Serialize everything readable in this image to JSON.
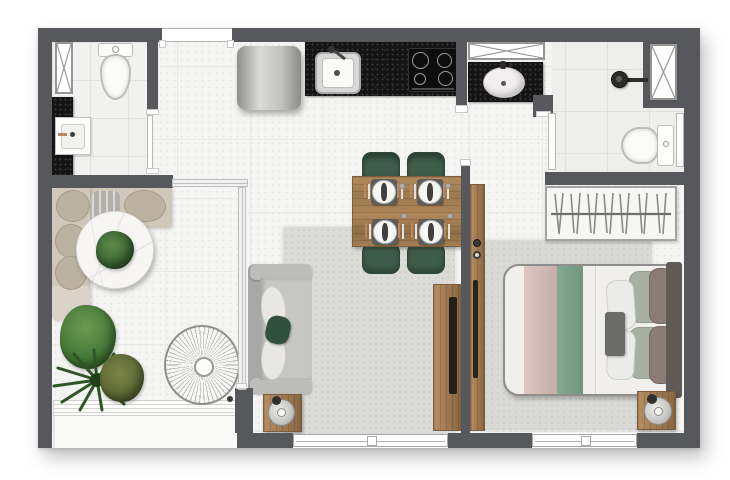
{
  "title": "Studio apartment floor plan (top-down architectural rendering, no visible text)",
  "canvas": {
    "width_px": 730,
    "height_px": 480
  },
  "palette": {
    "wall_gray": "#57585b",
    "floor_white": "#f4f4f2",
    "granite_black": "#141414",
    "wood_brown": "#a67e53",
    "chair_green": "#3f5d4b",
    "pillow_green": "#30503e",
    "bed_stripe_green": "#7ea28c",
    "bed_stripe_pink": "#d2bcb7",
    "rug_gray": "#dbdbd8",
    "sofa_gray": "#c6c6c4",
    "bench_beige": "#cfc8ba",
    "plant_green": "#3a6332",
    "glass_frame": "#bfc1c1"
  },
  "labels": {
    "balcony_bench": "L-shaped balcony bench with cushions",
    "round_table": "Round marble side table with plant centerpiece",
    "potted_plants": "Potted plants",
    "wire_chair": "Wire lounge chair (top view)",
    "railing": "Balcony edge railing",
    "dining_table": "Wood dining table with four place settings",
    "dining_chair": "Green dining chair",
    "sofa": "Gray two-seat sofa with cushions",
    "side_table": "Side table with lamp",
    "living_rug": "Living room area rug",
    "tv_panel": "Wood TV panel",
    "living_window": "Living room window",
    "refrigerator": "Refrigerator",
    "kitchen_counter": "Black granite kitchen counter",
    "kitchen_sink": "Kitchen sink",
    "cooktop": "Four-burner cooktop",
    "entry_door": "Entry door opening",
    "bath1": "Entry bathroom",
    "bath1_toilet": "Toilet",
    "bath1_sink": "Washbasin on black counter",
    "shaft": "Ventilation shaft",
    "bath2": "Suite bathroom",
    "bath2_vanity": "Vanity with oval sink",
    "shower": "Shower head",
    "bath2_toilet": "Toilet",
    "bath2_door": "Bathroom door",
    "closet": "Open closet rack with hangers",
    "wardrobe_panel": "Wood wardrobe panel",
    "bed": "Double bed with striped bedding and pillows",
    "nightstand": "Nightstand with lamp",
    "bedroom_rug": "Bedroom area rug",
    "bedroom_window": "Bedroom window",
    "glass_partition": "Glass partition between balcony and living room"
  }
}
